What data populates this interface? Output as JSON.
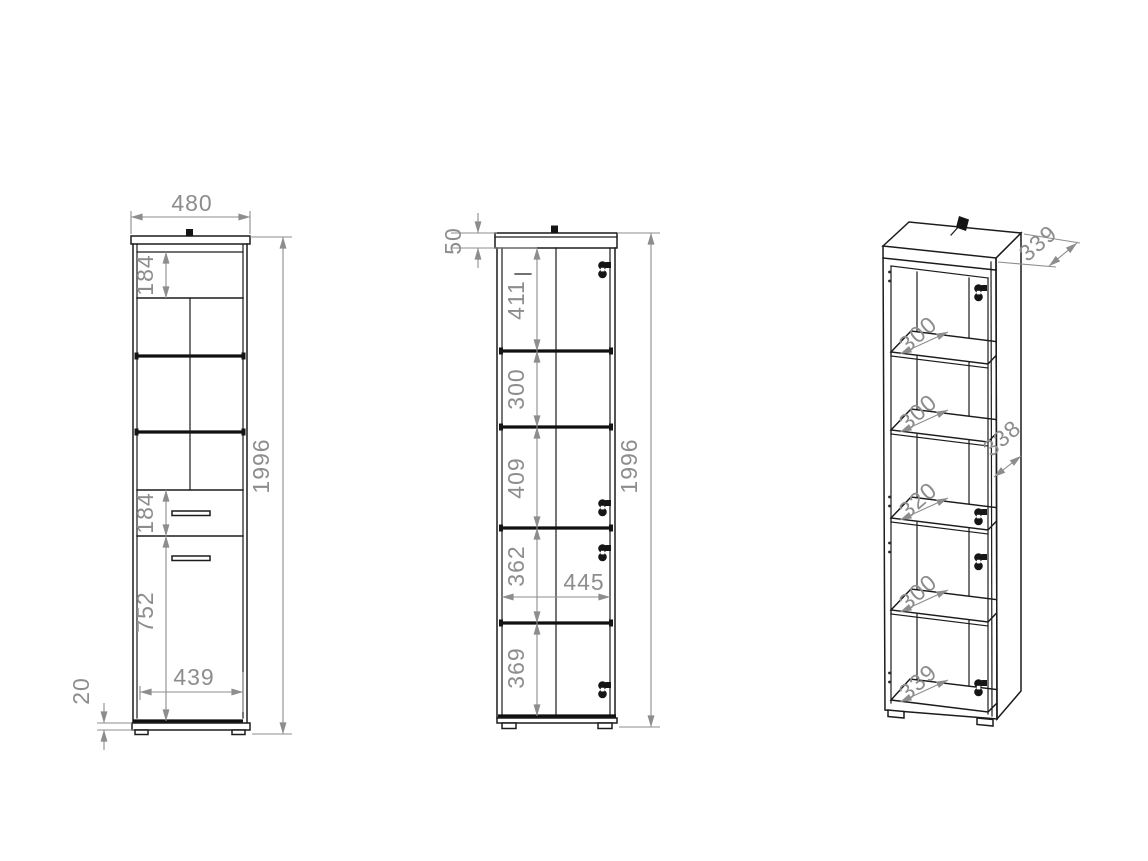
{
  "drawing": {
    "type": "furniture-technical-drawing",
    "background": "#ffffff",
    "line_color": "#1c1c1c",
    "dimension_color": "#8d8d8d"
  },
  "views": {
    "front_view": {
      "dimensions": {
        "overall_width": "480",
        "overall_height": "1996",
        "top_door_height": "184",
        "drawer_height": "184",
        "door_height": "752",
        "door_width": "439",
        "plinth_height": "20"
      }
    },
    "carcass_view": {
      "dimensions": {
        "top_panel": "50",
        "compartment_1": "411",
        "compartment_2": "300",
        "compartment_3": "409",
        "compartment_4": "362",
        "compartment_5": "369",
        "inner_width": "445",
        "overall_height": "1996"
      }
    },
    "perspective_view": {
      "dimensions": {
        "top_depth": "339",
        "side_depth": "338",
        "shelf_1_depth": "300",
        "shelf_2_depth": "300",
        "shelf_3_depth": "320",
        "shelf_4_depth": "300",
        "bottom_depth": "339"
      }
    }
  },
  "icons": {
    "hinge": "cabinet-hinge",
    "wall_bracket": "wall-mount-bracket"
  }
}
